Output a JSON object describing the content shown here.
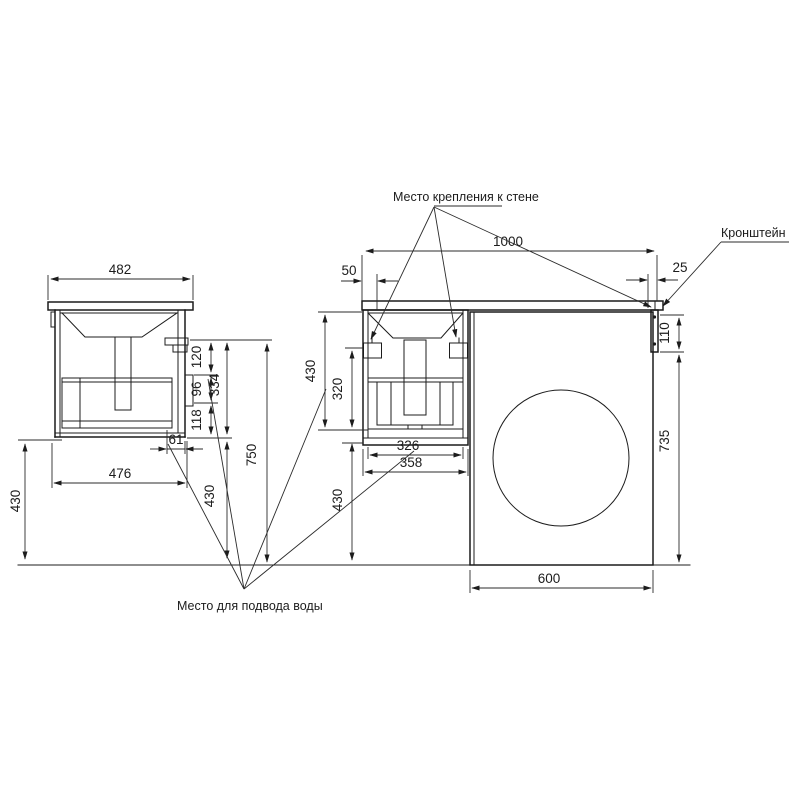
{
  "annotations": {
    "wall_mount": "Место крепления к стене",
    "bracket": "Кронштейн",
    "water_supply": "Место для подвода воды"
  },
  "dims": {
    "side_countertop_width": "482",
    "side_cabinet_width": "476",
    "side_back_offset": "61",
    "side_bracket_to_rail": "120",
    "side_rail_zone": "96",
    "side_rail_to_bottom": "118",
    "side_cabinet_height": "334",
    "side_wall_mount_height": "750",
    "side_floor_clearance_left": "430",
    "side_floor_clearance_right": "430",
    "front_total_width": "1000",
    "front_left_offset": "50",
    "front_right_offset": "25",
    "front_cabinet_height": "430",
    "front_bracket_to_bottom": "320",
    "front_floor_clearance": "430",
    "front_drawer_width": "326",
    "front_cabinet_width": "358",
    "wall_bracket_height": "110",
    "bracket_to_floor": "735",
    "washer_width": "600"
  }
}
